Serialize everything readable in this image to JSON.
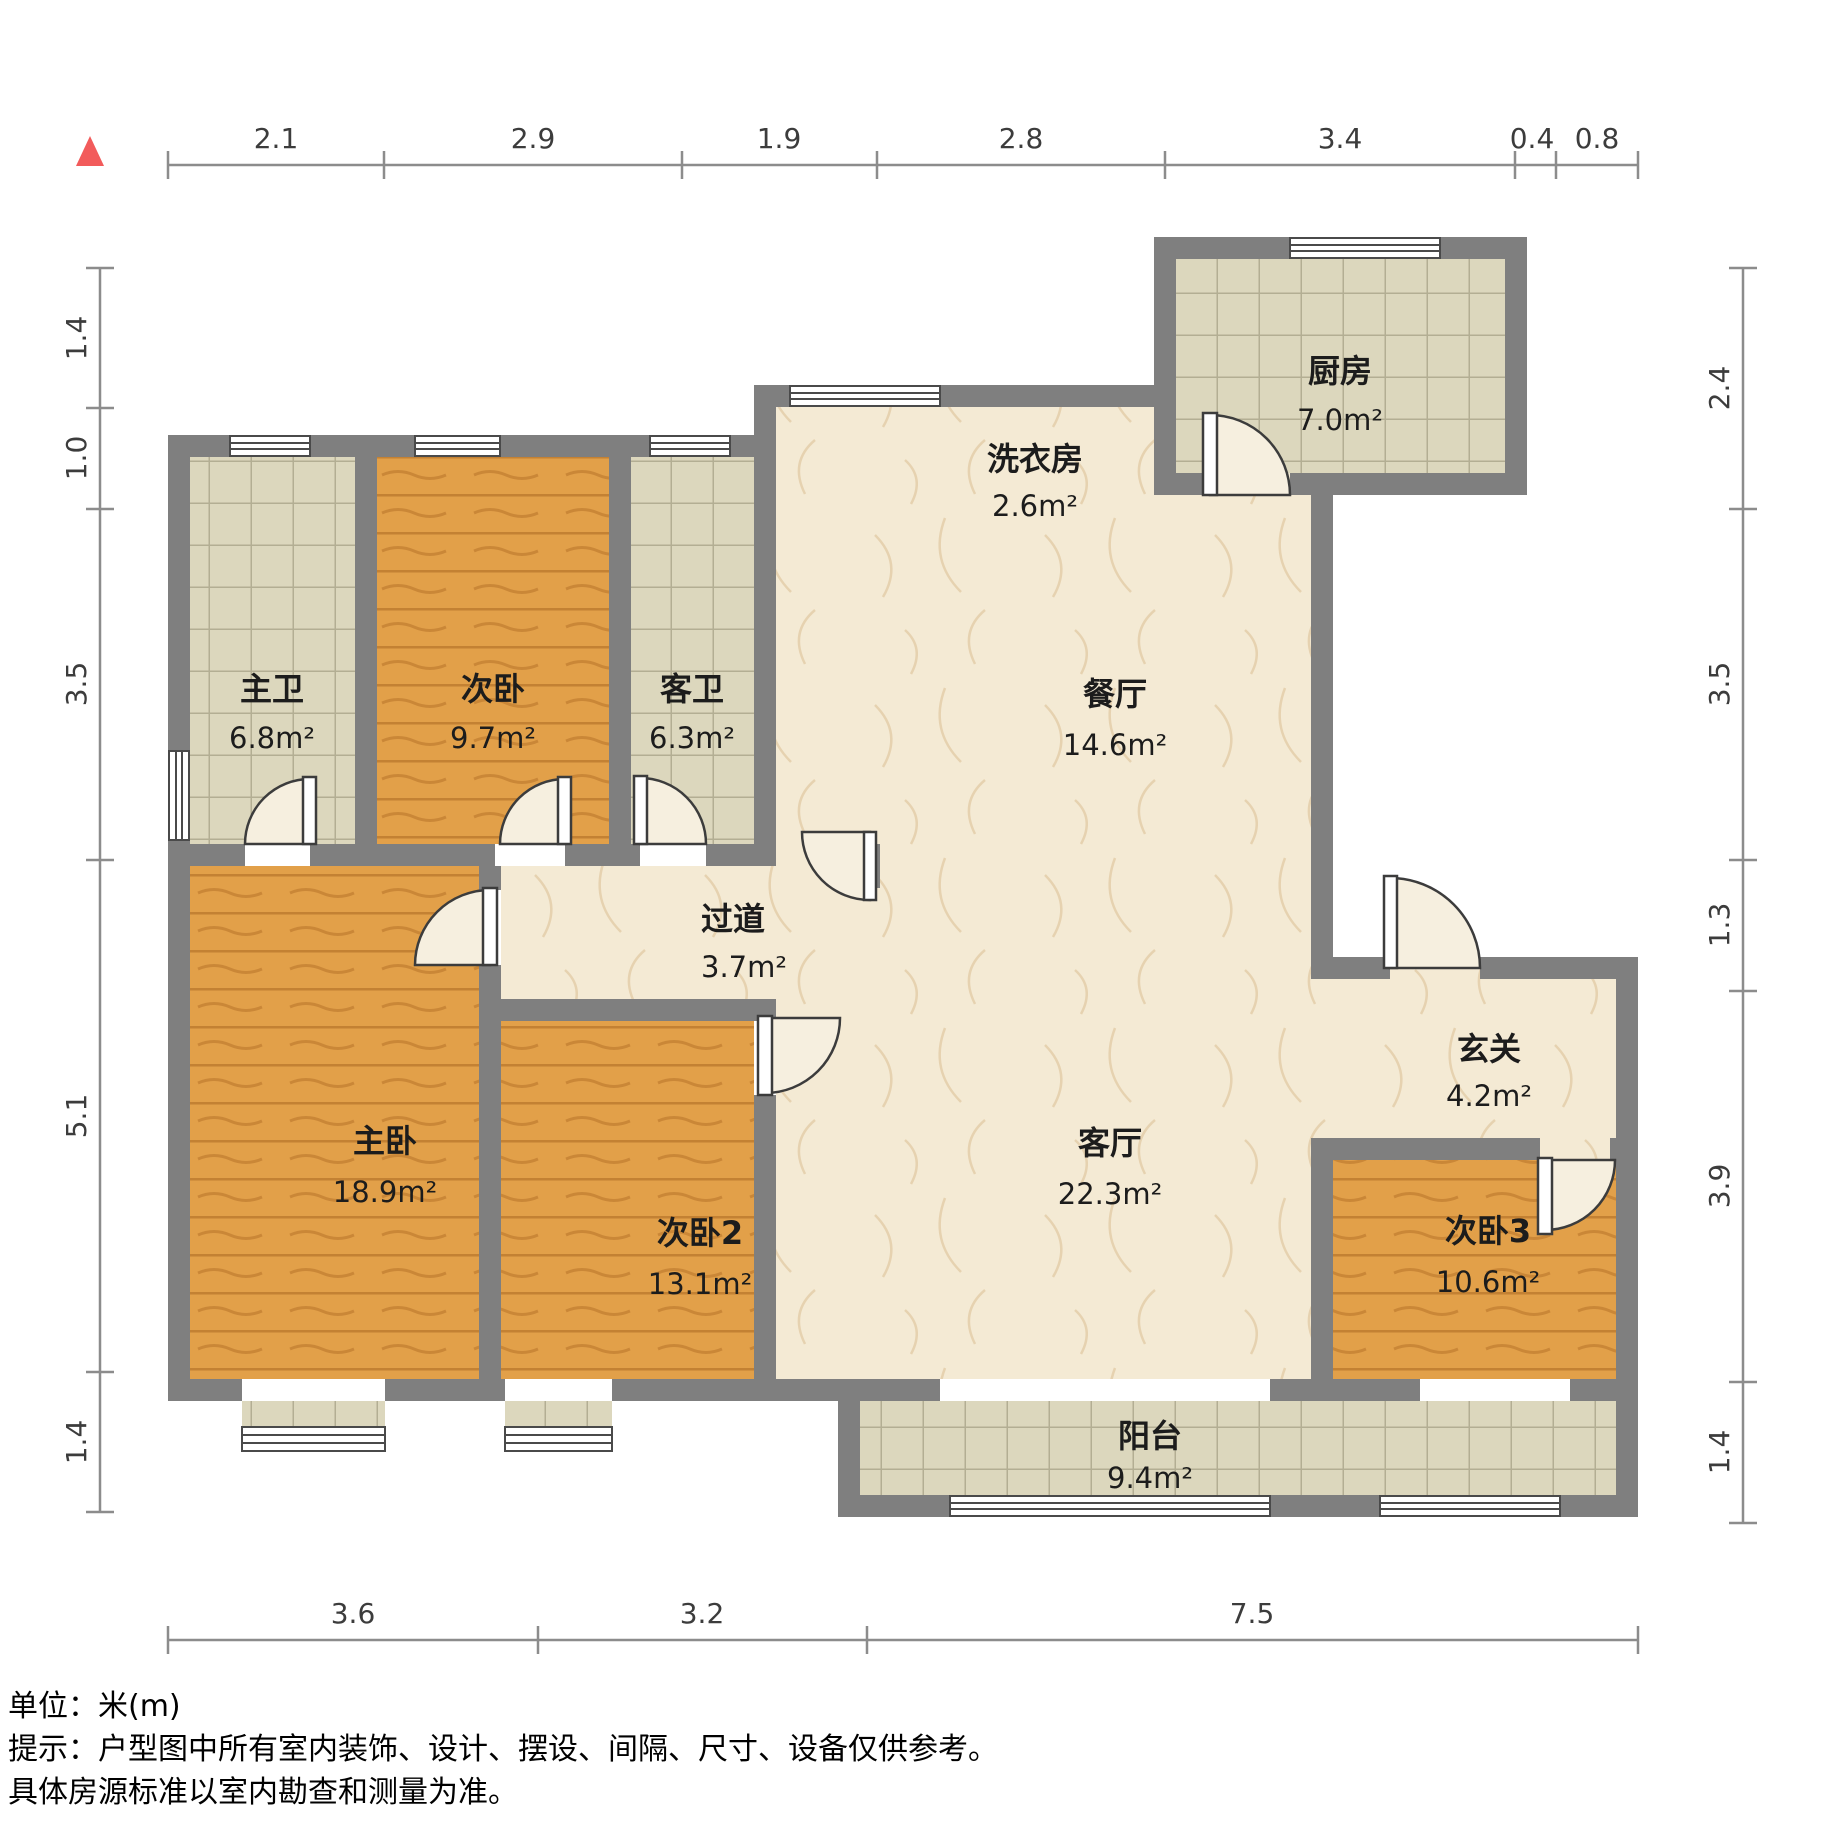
{
  "rooms": [
    {
      "id": "master-bath",
      "name": "主卫",
      "area": "6.8m²"
    },
    {
      "id": "bedroom-top",
      "name": "次卧",
      "area": "9.7m²"
    },
    {
      "id": "guest-bath",
      "name": "客卫",
      "area": "6.3m²"
    },
    {
      "id": "laundry",
      "name": "洗衣房",
      "area": "2.6m²"
    },
    {
      "id": "kitchen",
      "name": "厨房",
      "area": "7.0m²"
    },
    {
      "id": "dining",
      "name": "餐厅",
      "area": "14.6m²"
    },
    {
      "id": "hallway",
      "name": "过道",
      "area": "3.7m²"
    },
    {
      "id": "entry",
      "name": "玄关",
      "area": "4.2m²"
    },
    {
      "id": "master-bedroom",
      "name": "主卧",
      "area": "18.9m²"
    },
    {
      "id": "bedroom2",
      "name": "次卧2",
      "area": "13.1m²"
    },
    {
      "id": "living",
      "name": "客厅",
      "area": "22.3m²"
    },
    {
      "id": "bedroom3",
      "name": "次卧3",
      "area": "10.6m²"
    },
    {
      "id": "balcony",
      "name": "阳台",
      "area": "9.4m²"
    }
  ],
  "dimensions": {
    "top": [
      "2.1",
      "2.9",
      "1.9",
      "2.8",
      "3.4",
      "0.4",
      "0.8"
    ],
    "left": [
      "1.4",
      "1.0",
      "3.5",
      "5.1",
      "1.4"
    ],
    "right": [
      "2.4",
      "3.5",
      "1.3",
      "3.9",
      "1.4"
    ],
    "bottom": [
      "3.6",
      "3.2",
      "7.5"
    ]
  },
  "footer": {
    "unit": "单位：米(m)",
    "tip1": "提示：户型图中所有室内装饰、设计、摆设、间隔、尺寸、设备仅供参考。",
    "tip2": "具体房源标准以室内勘查和测量为准。"
  },
  "colors": {
    "wall": "#7f7f7f",
    "wood_floor": "#e2a049",
    "tile_floor": "#dcd7bd",
    "marble_floor": "#f4ead4",
    "dimension_line": "#8c8c8c",
    "north_arrow": "#f25b5b"
  }
}
